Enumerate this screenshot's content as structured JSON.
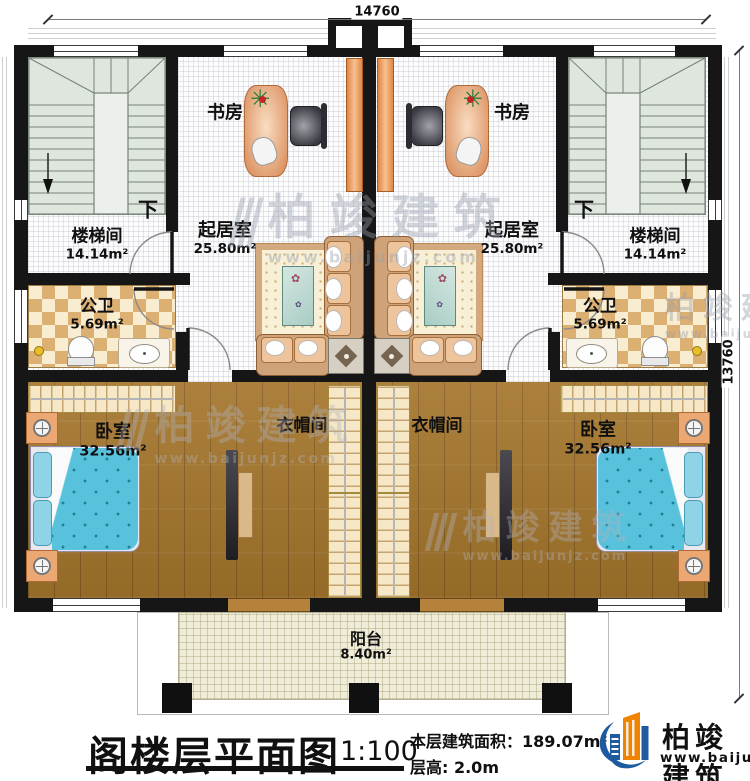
{
  "plan": {
    "dim_top": "14760",
    "dim_right": "13760",
    "down_left": "下",
    "down_right": "下",
    "rooms": {
      "stair_left": {
        "name": "楼梯间",
        "area": "14.14m²"
      },
      "stair_right": {
        "name": "楼梯间",
        "area": "14.14m²"
      },
      "study_left": {
        "name": "书房"
      },
      "study_right": {
        "name": "书房"
      },
      "living_left": {
        "name": "起居室",
        "area": "25.80m²"
      },
      "living_right": {
        "name": "起居室",
        "area": "25.80m²"
      },
      "bath_left": {
        "name": "公卫",
        "area": "5.69m²"
      },
      "bath_right": {
        "name": "公卫",
        "area": "5.69m²"
      },
      "bedroom_left": {
        "name": "卧室",
        "area": "32.56m²"
      },
      "bedroom_right": {
        "name": "卧室",
        "area": "32.56m²"
      },
      "closet_left": {
        "name": "衣帽间"
      },
      "closet_right": {
        "name": "衣帽间"
      },
      "balcony": {
        "name": "阳台",
        "area": "8.40m²"
      }
    }
  },
  "titleblock": {
    "title": "阁楼层平面图",
    "scale": "1:100",
    "floor_area": "本层建筑面积：189.07m²",
    "floor_height": "层高: 2.0m"
  },
  "logo": {
    "name": "柏竣建筑",
    "website": "www.baijunjz.com"
  },
  "watermark": {
    "name": "柏竣建筑",
    "website": "www.baijunjz.com"
  },
  "colors": {
    "wall": "#161616",
    "wood_floor": "#a5762c",
    "bath_checker": "#dcaf72",
    "stair_fill": "#dfe6dd",
    "bed_fill": "#58c2dc",
    "furniture_orange": "#e08648",
    "balcony_fill": "#efecd8",
    "logo_blue": "#1e5aa0",
    "logo_orange": "#f08300"
  }
}
